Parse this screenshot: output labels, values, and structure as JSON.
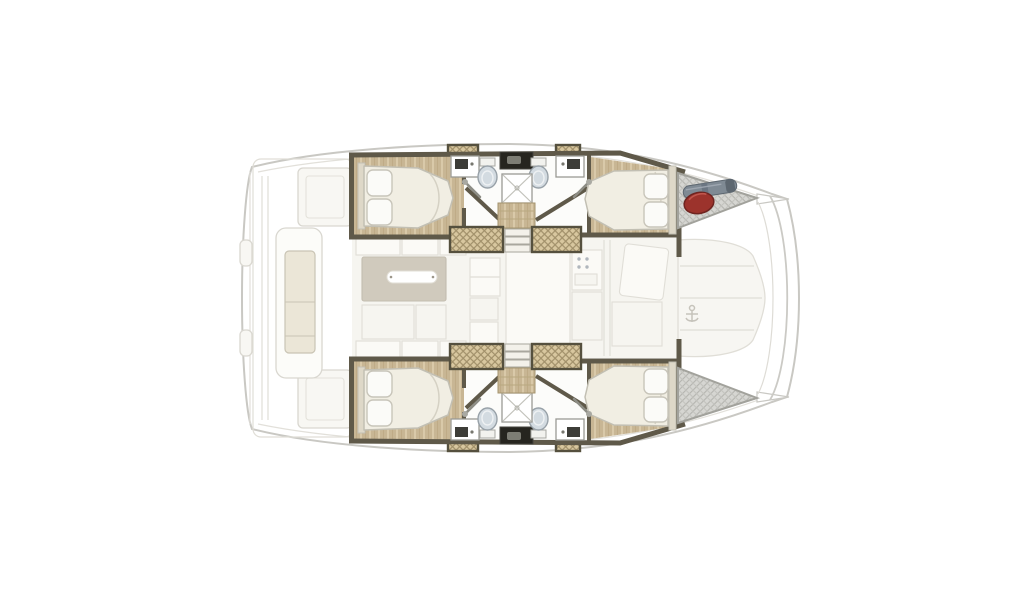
{
  "page": {
    "background": "#ffffff",
    "width_px": 1024,
    "height_px": 600
  },
  "floorplan": {
    "subject": "catamaran-yacht-deck-layout-top-view",
    "orientation": "bow-right-stern-left",
    "hulls": {
      "port_hull_top": [
        "aft-double-cabin-bed-with-two-pillows",
        "bathroom-two-toilets-two-sinks-central-shower",
        "forward-double-cabin-bed-with-two-pillows",
        "bow-storage-hatch-with-red-fender-and-gray-roll"
      ],
      "starboard_hull_bottom": [
        "aft-double-cabin-bed-with-two-pillows",
        "bathroom-two-toilets-two-sinks-central-shower",
        "forward-double-cabin-bed-with-two-pillows",
        "bow-storage-hatch"
      ]
    },
    "center_deck": [
      "aft-cockpit-with-bench-and-lockers",
      "saloon-table-with-seats",
      "galley-units",
      "companionway-steps",
      "foredeck-panels",
      "anchor-fitting"
    ],
    "colors": {
      "background": "#ffffff",
      "hull_outline": "#c9c8c3",
      "hull_inner_line": "#e2e0da",
      "faded_fill": "#f6f5f0",
      "faded_stroke": "#e0ded7",
      "panel_fill": "#fbfaf6",
      "locker_fill": "#f8f7f3",
      "locker_stroke": "#d9d7d0",
      "wood_floor": "#c8b694",
      "wood_grain": "#d9c9a9",
      "wood_step_line": "#b9a87f",
      "wall": "#5f5949",
      "bath_floor": "#fcfcfa",
      "fixture_stroke": "#9a9a94",
      "toilet_fill": "#d3dbe1",
      "toilet_stroke": "#98a1a8",
      "black_unit": "#26251f",
      "black_unit_inner": "#7d7d74",
      "hatch_tan": "#d8c79f",
      "hatch_tan_line": "#a1906a",
      "hatch_border": "#55503e",
      "step_fill": "#f3f1ea",
      "mattress": "#f1eee3",
      "mattress_stroke": "#c2bfb3",
      "pillow": "#fbfbf8",
      "pillow_stroke": "#c8c5ba",
      "bow_hatch": "#d6d6d2",
      "bow_hatch_line": "#b4b4af",
      "bow_hatch_stroke": "#a2a29c",
      "fender_red": "#9c332c",
      "fender_outline": "#6f2420",
      "roll_gray": "#7f8a94",
      "roll_dark": "#5d6770",
      "table": "#d0cabd",
      "table_pill": "#ffffff",
      "cushion": "#ebe6d7",
      "cushion_stroke": "#c9c4b4"
    }
  }
}
